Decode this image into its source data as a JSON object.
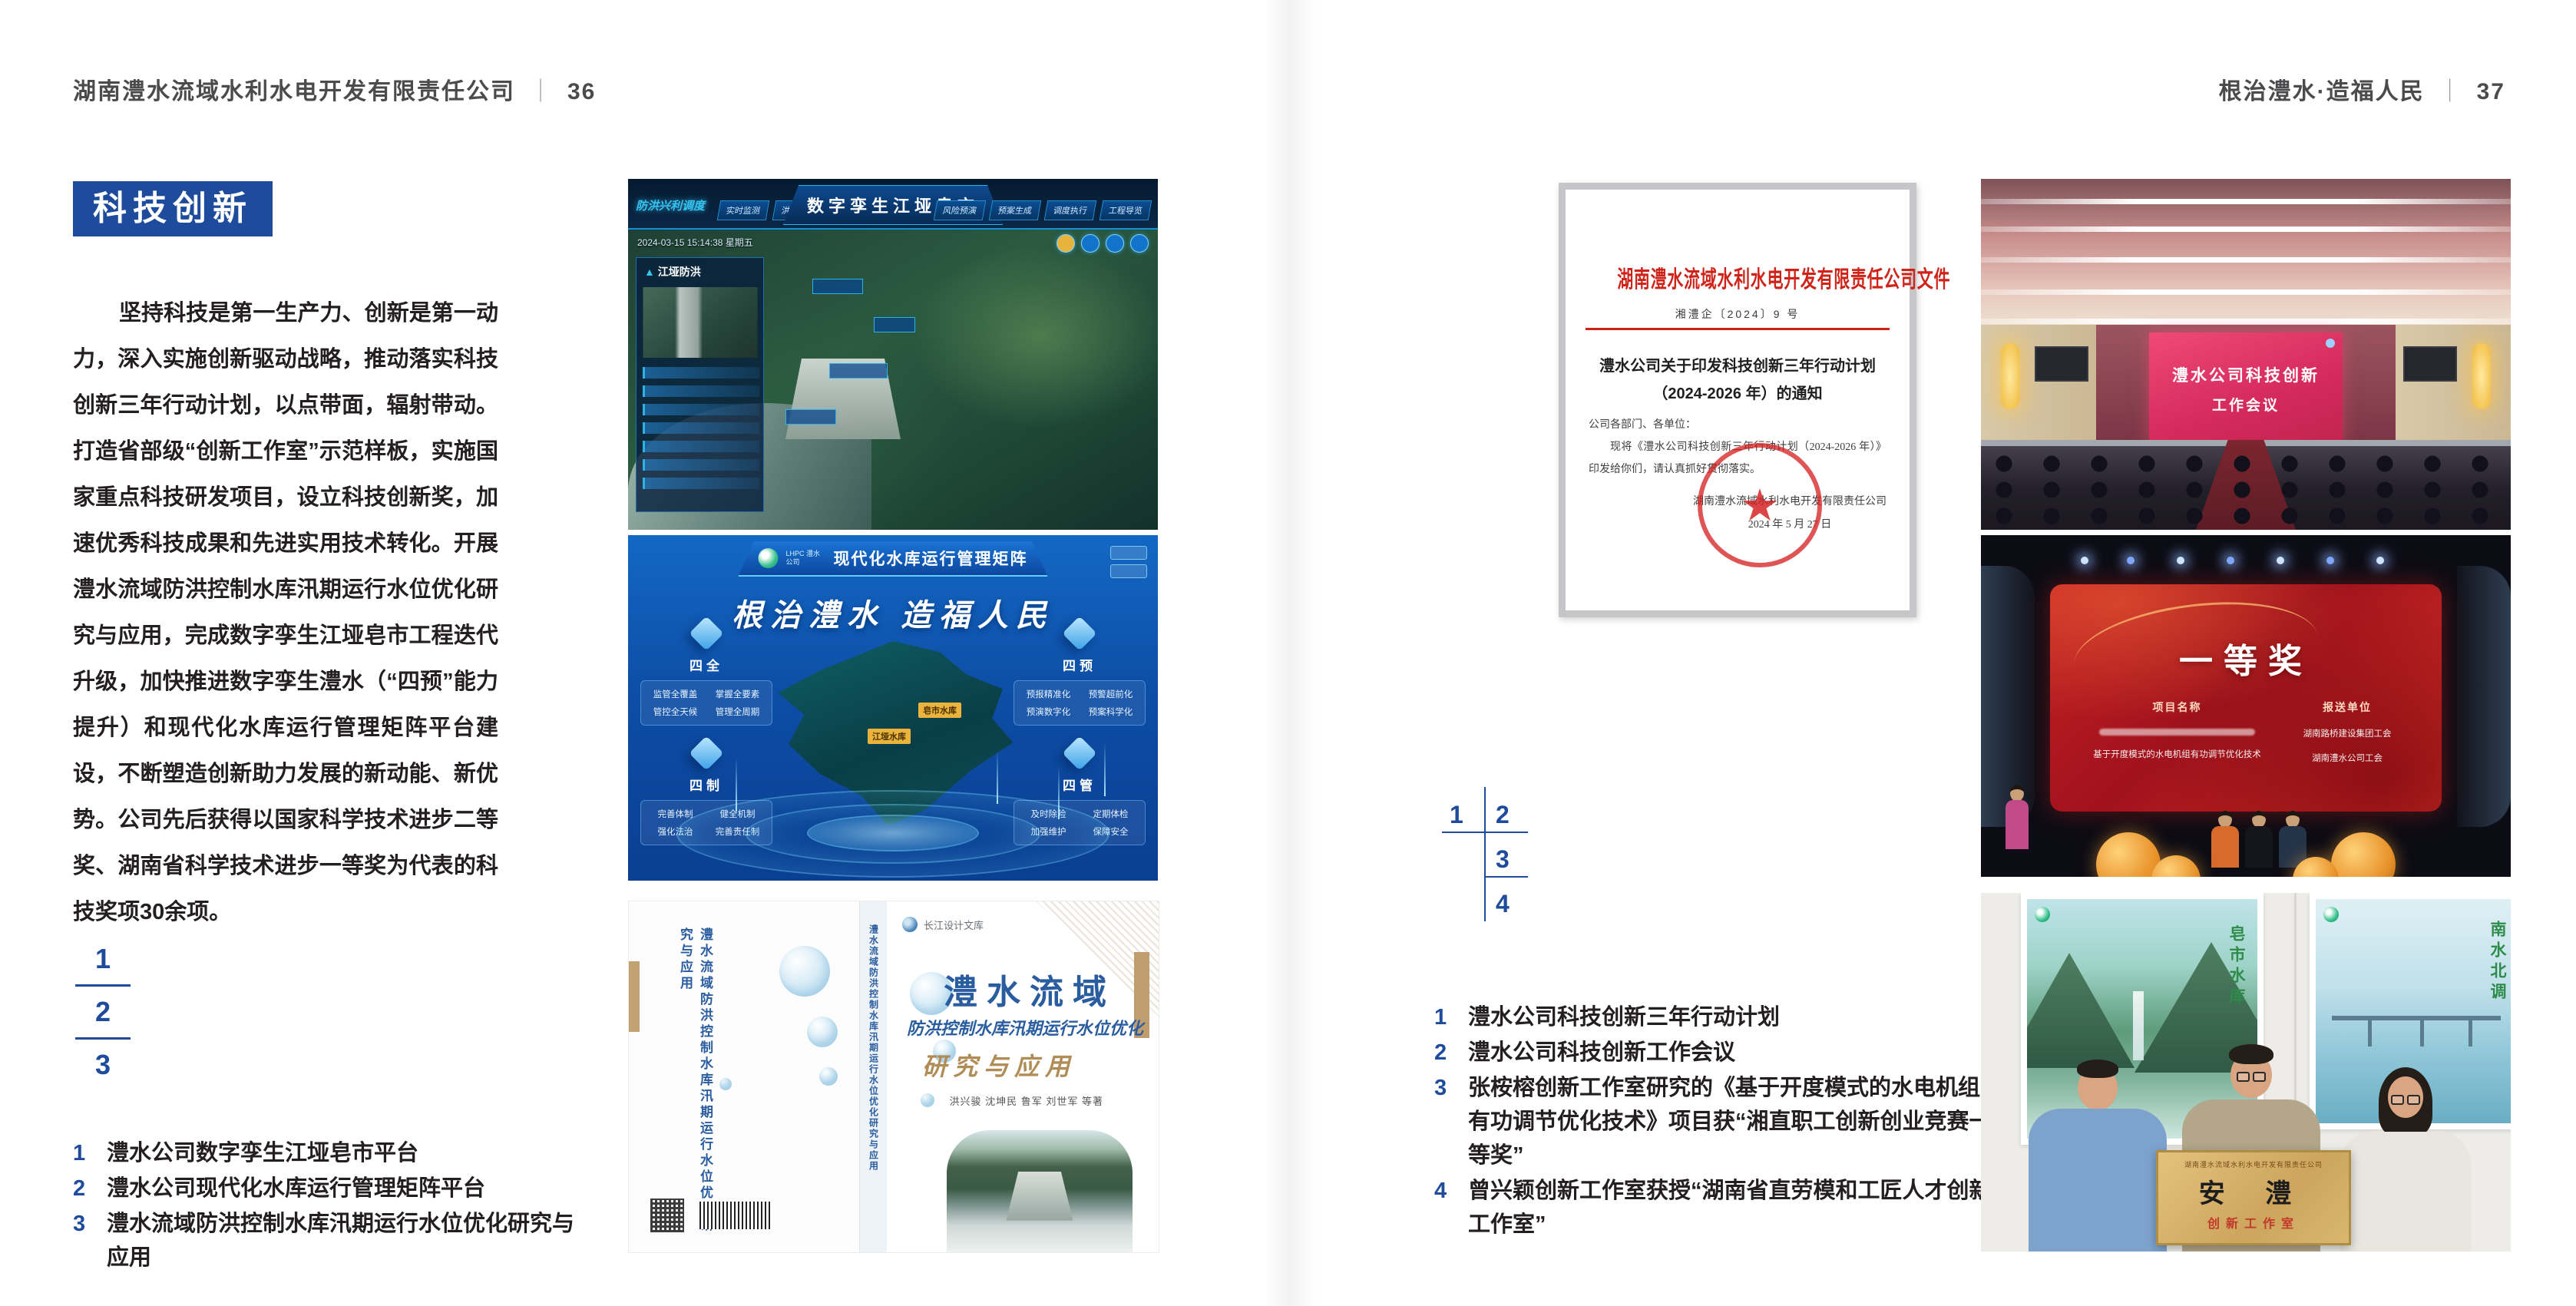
{
  "page": {
    "accent_color": "#1e4b9c",
    "header_left": {
      "company": "湖南澧水流域水利水电开发有限责任公司",
      "divider": "｜",
      "page_no": "36"
    },
    "header_right": {
      "title": "根治澧水·造福人民",
      "divider": "｜",
      "page_no": "37"
    }
  },
  "left_page": {
    "section_badge": "科技创新",
    "body_paragraph": "坚持科技是第一生产力、创新是第一动力，深入实施创新驱动战略，推动落实科技创新三年行动计划，以点带面，辐射带动。打造省部级“创新工作室”示范样板，实施国家重点科技研发项目，设立科技创新奖，加速优秀科技成果和先进实用技术转化。开展澧水流域防洪控制水库汛期运行水位优化研究与应用，完成数字孪生江垭皂市工程迭代升级，加快推进数字孪生澧水（“四预”能力提升）和现代化水库运行管理矩阵平台建设，不断塑造创新助力发展的新动能、新优势。公司先后获得以国家科学技术进步二等奖、湖南省科学技术进步一等奖为代表的科技奖项30余项。",
    "figure_index": [
      "1",
      "2",
      "3"
    ],
    "captions": [
      {
        "num": "1",
        "text": "澧水公司数字孪生江垭皂市平台"
      },
      {
        "num": "2",
        "text": "澧水公司现代化水库运行管理矩阵平台"
      },
      {
        "num": "3",
        "text": "澧水流域防洪控制水库汛期运行水位优化研究与应用"
      }
    ]
  },
  "right_page": {
    "document": {
      "red_title": "湖南澧水流域水利水电开发有限责任公司文件",
      "doc_number": "湘澧企〔2024〕9 号",
      "title_line1": "澧水公司关于印发科技创新三年行动计划",
      "title_line2": "（2024-2026 年）的通知",
      "salutation": "公司各部门、各单位：",
      "body": "现将《澧水公司科技创新三年行动计划（2024-2026 年）》印发给你们，请认真抓好贯彻落实。",
      "signature": "湖南澧水流域水利水电开发有限责任公司",
      "date": "2024 年 5 月 27 日"
    },
    "figure_index": [
      "1",
      "2",
      "3",
      "4"
    ],
    "captions": [
      {
        "num": "1",
        "text": "澧水公司科技创新三年行动计划"
      },
      {
        "num": "2",
        "text": "澧水公司科技创新工作会议"
      },
      {
        "num": "3",
        "text": "张桉榕创新工作室研究的《基于开度模式的水电机组有功调节优化技术》项目获“湘直职工创新创业竞赛一等奖”"
      },
      {
        "num": "4",
        "text": "曾兴颖创新工作室获授“湖南省直劳模和工匠人才创新工作室”"
      }
    ]
  },
  "figures": {
    "dashboard": {
      "title": "数字孪生江垭皂市",
      "brand": "防洪兴利调度",
      "tabs_left": [
        "实时监测",
        "洪水预报",
        "防洪预警"
      ],
      "tabs_right": [
        "风险预演",
        "预案生成",
        "调度执行",
        "工程导览"
      ],
      "timestamp": "2024-03-15 15:14:38 星期五",
      "panel_title": "江垭防洪"
    },
    "matrix": {
      "logo_text": "LHPC 澧水公司",
      "title": "现代化水库运行管理矩阵",
      "slogan": "根治澧水 造福人民",
      "groups": [
        {
          "name": "四全",
          "items": [
            "监管全覆盖",
            "掌握全要素",
            "管控全天候",
            "管理全周期"
          ]
        },
        {
          "name": "四预",
          "items": [
            "预报精准化",
            "预警超前化",
            "预演数字化",
            "预案科学化"
          ]
        },
        {
          "name": "四制",
          "items": [
            "完善体制",
            "健全机制",
            "强化法治",
            "完善责任制"
          ]
        },
        {
          "name": "四管",
          "items": [
            "及时除险",
            "定期体检",
            "加强维护",
            "保障安全"
          ]
        }
      ],
      "map_tags": [
        "皂市水库",
        "江垭水库"
      ]
    },
    "book": {
      "series": "长江设计文库",
      "title_main": "澧水流域",
      "title_sub": "防洪控制水库汛期运行水位优化",
      "title_tail": "研究与应用",
      "authors": "洪兴骏 沈坤民 鲁军 刘世军 等著",
      "spine_text": "澧水流域防洪控制水库汛期运行水位优化研究与应用"
    },
    "meeting": {
      "screen_line1": "澧水公司科技创新",
      "screen_line2": "工作会议"
    },
    "award": {
      "headline": "一等奖",
      "col_left": "项目名称",
      "col_right": "报送单位",
      "project": "基于开度模式的水电机组有功调节优化技术",
      "unit1": "湖南路桥建设集团工会",
      "unit2": "湖南澧水公司工会"
    },
    "plaque": {
      "poster_left_caption": "皂市水库",
      "poster_right_caption": "南水北调",
      "board_org": "湖南澧水流域水利水电开发有限责任公司",
      "board_title": "安 澧",
      "board_subtitle": "创新工作室"
    }
  }
}
